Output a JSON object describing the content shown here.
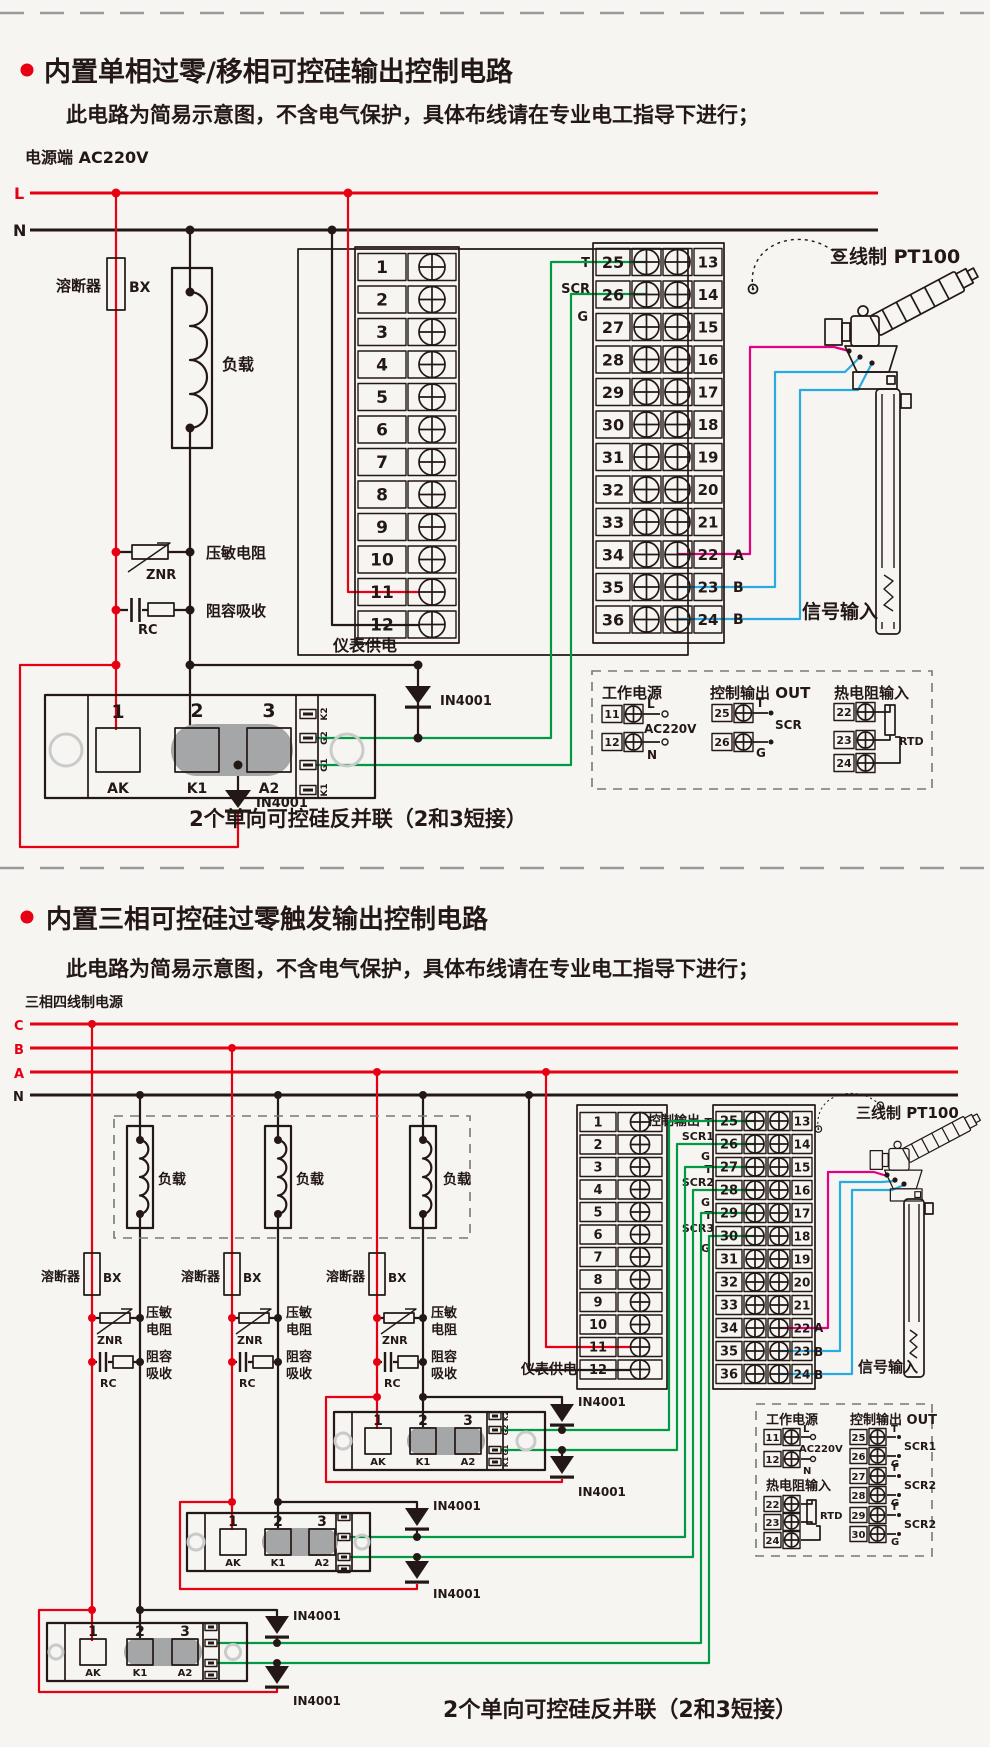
{
  "s1": {
    "title": "内置单相过零/移相可控硅输出控制电路",
    "subtitle": "此电路为简易示意图，不含电气保护，具体布线请在专业电工指导下进行；",
    "power": "电源端  AC220V",
    "busL": "L",
    "busN": "N",
    "fuse": "溶断器",
    "fuseCode": "BX",
    "load": "负载",
    "znr": "压敏电阻",
    "znrCode": "ZNR",
    "rc": "阻容吸收",
    "rcCode": "RC",
    "meter": "仪表供电",
    "diode": "IN4001",
    "t": "T",
    "scr": "SCR",
    "g": "G",
    "a": "A",
    "b": "B",
    "signal": "信号输入",
    "pt100": "三线制 PT100",
    "caption": "2个单向可控硅反并联（2和3短接）",
    "modNums": [
      "1",
      "2",
      "3"
    ],
    "modPins": [
      "AK",
      "K1",
      "A2"
    ],
    "modSide": [
      "K2",
      "G2",
      "G1",
      "K1"
    ],
    "stripL": [
      "1",
      "2",
      "3",
      "4",
      "5",
      "6",
      "7",
      "8",
      "9",
      "10",
      "11",
      "12"
    ],
    "stripM": [
      "25",
      "26",
      "27",
      "28",
      "29",
      "30",
      "31",
      "32",
      "33",
      "34",
      "35",
      "36"
    ],
    "stripR": [
      "13",
      "14",
      "15",
      "16",
      "17",
      "18",
      "19",
      "20",
      "21",
      "22",
      "23",
      "24"
    ],
    "legend": {
      "power": "工作电源",
      "out": "控制输出 OUT",
      "rtd": "热电阻输入",
      "l": "L",
      "n": "N",
      "v": "AC220V",
      "t": "T",
      "g": "G",
      "scr": "SCR",
      "rtdCode": "RTD",
      "powerNums": [
        "11",
        "12"
      ],
      "outNums": [
        "25",
        "26"
      ],
      "rtdNums": [
        "22",
        "23",
        "24"
      ]
    }
  },
  "s2": {
    "title": "内置三相可控硅过零触发输出控制电路",
    "subtitle": "此电路为简易示意图，不含电气保护，具体布线请在专业电工指导下进行；",
    "power": "三相四线制电源",
    "bus": [
      "C",
      "B",
      "A",
      "N"
    ],
    "fuse": "溶断器",
    "fuseCode": "BX",
    "load": "负载",
    "znr1": "压敏",
    "znr2": "电阻",
    "znrCode": "ZNR",
    "rc1": "阻容",
    "rc2": "吸收",
    "rcCode": "RC",
    "meter": "仪表供电",
    "diode": "IN4001",
    "outHeader": "控制输出",
    "t": "T",
    "g": "G",
    "scr1": "SCR1",
    "scr2": "SCR2",
    "scr3": "SCR3",
    "a": "A",
    "b": "B",
    "signal": "信号输入",
    "pt100": "三线制 PT100",
    "caption": "2个单向可控硅反并联（2和3短接）",
    "modNums": [
      "1",
      "2",
      "3"
    ],
    "modPins": [
      "AK",
      "K1",
      "A2"
    ],
    "modSide": [
      "K2",
      "G2",
      "G1",
      "K1"
    ],
    "stripL": [
      "1",
      "2",
      "3",
      "4",
      "5",
      "6",
      "7",
      "8",
      "9",
      "10",
      "11",
      "12"
    ],
    "stripM": [
      "25",
      "26",
      "27",
      "28",
      "29",
      "30",
      "31",
      "32",
      "33",
      "34",
      "35",
      "36"
    ],
    "stripR": [
      "13",
      "14",
      "15",
      "16",
      "17",
      "18",
      "19",
      "20",
      "21",
      "22",
      "23",
      "24"
    ],
    "legend": {
      "power": "工作电源",
      "out": "控制输出 OUT",
      "rtd": "热电阻输入",
      "l": "L",
      "n": "N",
      "v": "AC220V",
      "t": "T",
      "g": "G",
      "names": [
        "SCR1",
        "SCR2",
        "SCR2"
      ],
      "rtdCode": "RTD",
      "powerNums": [
        "11",
        "12"
      ],
      "outNums": [
        "25",
        "26",
        "27",
        "28",
        "29",
        "30"
      ],
      "rtdNums": [
        "22",
        "23",
        "24"
      ]
    }
  }
}
